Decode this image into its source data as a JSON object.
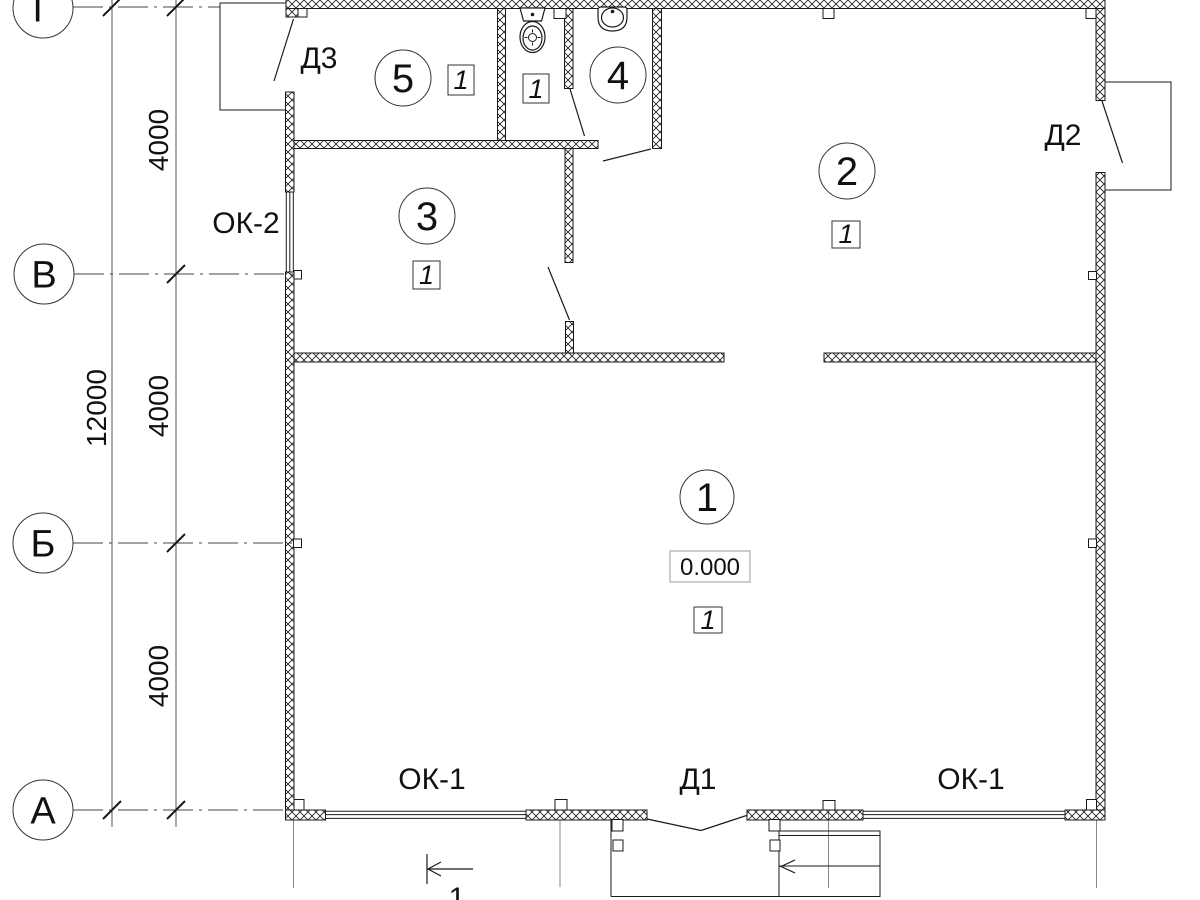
{
  "axes": {
    "g": "Г",
    "v": "В",
    "b": "Б",
    "a": "А"
  },
  "dims": {
    "total": "12000",
    "seg1": "4000",
    "seg2": "4000",
    "seg3": "4000"
  },
  "doors": {
    "d1": "Д1",
    "d2": "Д2",
    "d3": "Д3"
  },
  "windows": {
    "ok1_left": "ОК-1",
    "ok1_right": "ОК-1",
    "ok2": "ОК-2"
  },
  "rooms": {
    "room1": {
      "number": "1",
      "floor": "1",
      "elevation": "0.000"
    },
    "room2": {
      "number": "2",
      "floor": "1"
    },
    "room3": {
      "number": "3",
      "floor": "1"
    },
    "room4": {
      "number": "4"
    },
    "room5": {
      "number": "5",
      "floor": "1"
    },
    "wc": {
      "floor": "1"
    }
  },
  "section": {
    "label": "1"
  },
  "colors": {
    "line": "#1a1a1a",
    "axis_line": "#444444",
    "elevation_box_border": "#bcbcbc"
  },
  "fixtures": {
    "toilet": "toilet-plan-symbol",
    "sink": "sink-plan-symbol"
  }
}
